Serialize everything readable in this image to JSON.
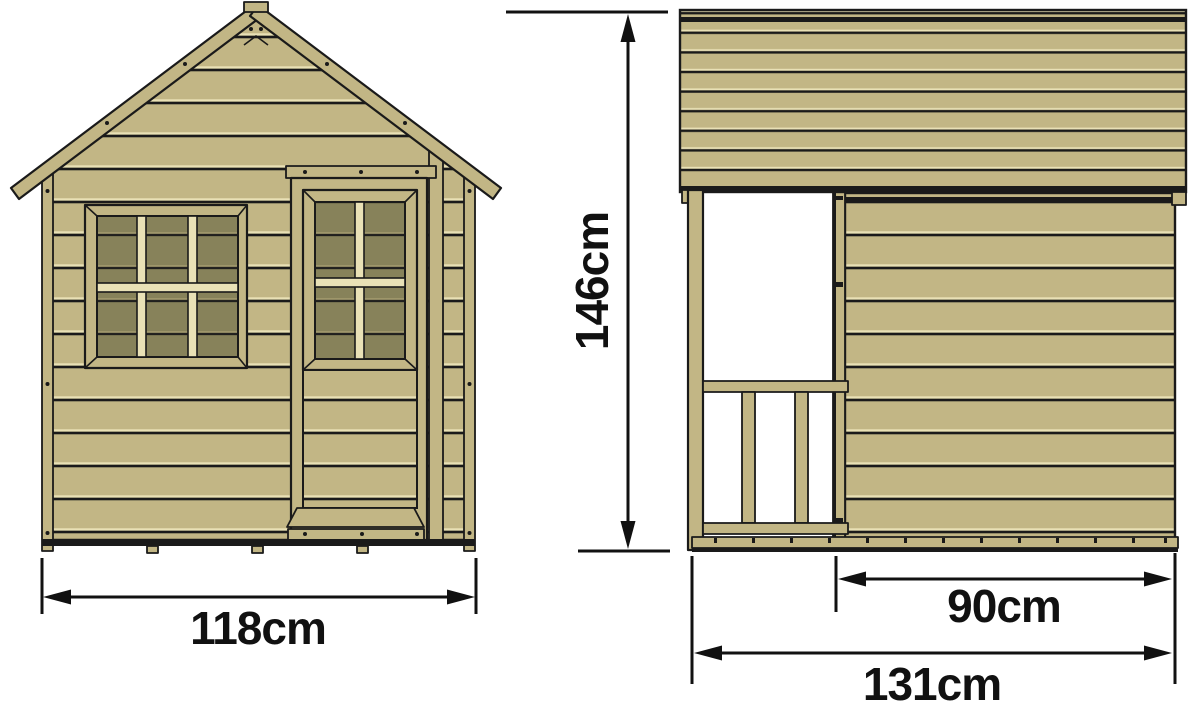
{
  "diagram": {
    "front_view": {
      "width_dimension": {
        "value": "118cm"
      }
    },
    "side_view": {
      "height_dimension": {
        "value": "146cm"
      },
      "door_to_back_dimension": {
        "value": "90cm"
      },
      "depth_dimension": {
        "value": "131cm"
      }
    }
  },
  "colors": {
    "bg": "#ffffff",
    "wood": "#c2b685",
    "wood_light": "#e9e1b6",
    "glass": "#87825a",
    "glass_light": "#a79f72",
    "outline": "#1a1a1a",
    "dim": "#111111"
  }
}
